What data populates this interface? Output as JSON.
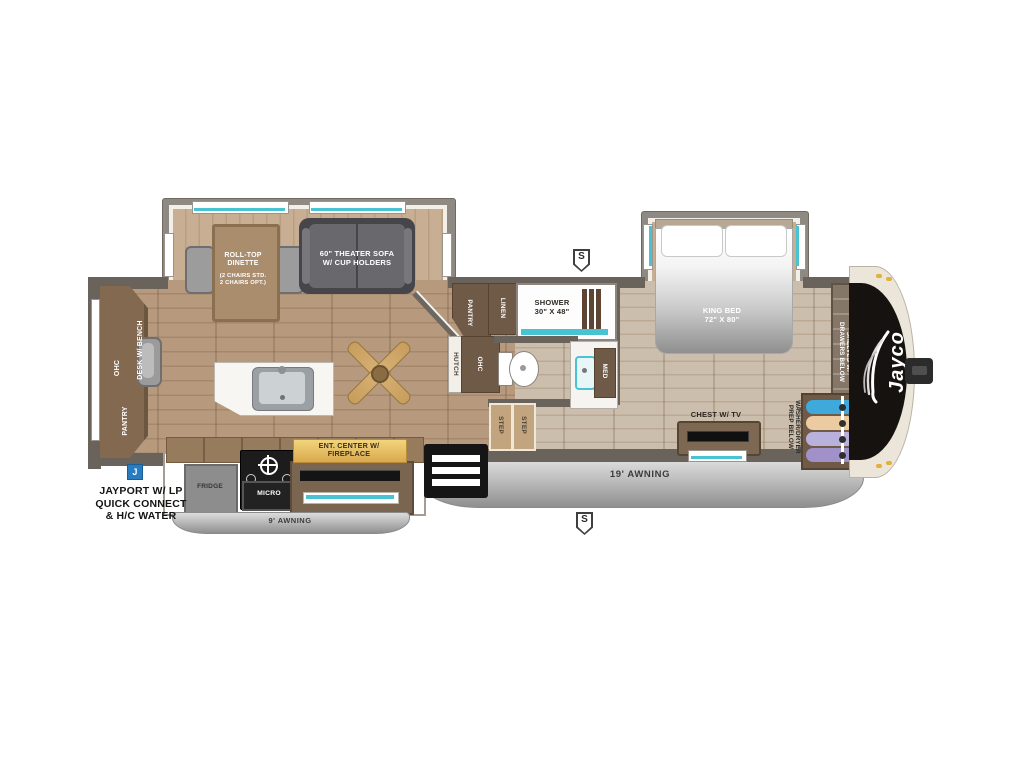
{
  "brand": {
    "logo": "Jayco"
  },
  "exterior": {
    "jayport_label": "JAYPORT W/ LP\nQUICK CONNECT\n& H/C WATER",
    "awning_rear": "9' AWNING",
    "awning_main": "19' AWNING",
    "marker_j": "J",
    "marker_s_top": "S",
    "marker_s_bottom": "S"
  },
  "living_area": {
    "dinette_label": "ROLL-TOP\nDINETTE",
    "dinette_note": "(2 CHAIRS STD.\n2 CHAIRS OPT.)",
    "sofa_label": "60\" THEATER SOFA\nW/ CUP HOLDERS",
    "ohc_rear": "OHC",
    "desk_label": "DESK W/ BENCH",
    "pantry_rear": "PANTRY",
    "hutch_label": "HUTCH",
    "ohc_mid": "OHC",
    "pantry_mid": "PANTRY",
    "ent_center_label": "ENT. CENTER W/\nFIREPLACE",
    "fridge_label": "FRIDGE",
    "micro_label": "MICRO"
  },
  "bathroom": {
    "shower_label": "SHOWER\n30\" X 48\"",
    "linen_label": "LINEN",
    "med_label": "MED",
    "step_label_1": "STEP",
    "step_label_2": "STEP"
  },
  "bedroom": {
    "bed_label": "KING BED\n72\" X 80\"",
    "chest_label": "CHEST W/ TV",
    "washer_label": "WASHER/DRYER\nPREP BELOW",
    "shelves_label": "SHELVES W/\nDRAWERS BELOW"
  },
  "colors": {
    "teal_accent": "#49c3d2",
    "gold_accent": "#e8c36a",
    "marker_blue": "#2a7cc0",
    "cap_black": "#16120f",
    "shirt_blue": "#3fa9dc",
    "shirt_tan": "#eccaa2",
    "shirt_lavender": "#b7b1dc",
    "shirt_purple": "#a191c9"
  }
}
